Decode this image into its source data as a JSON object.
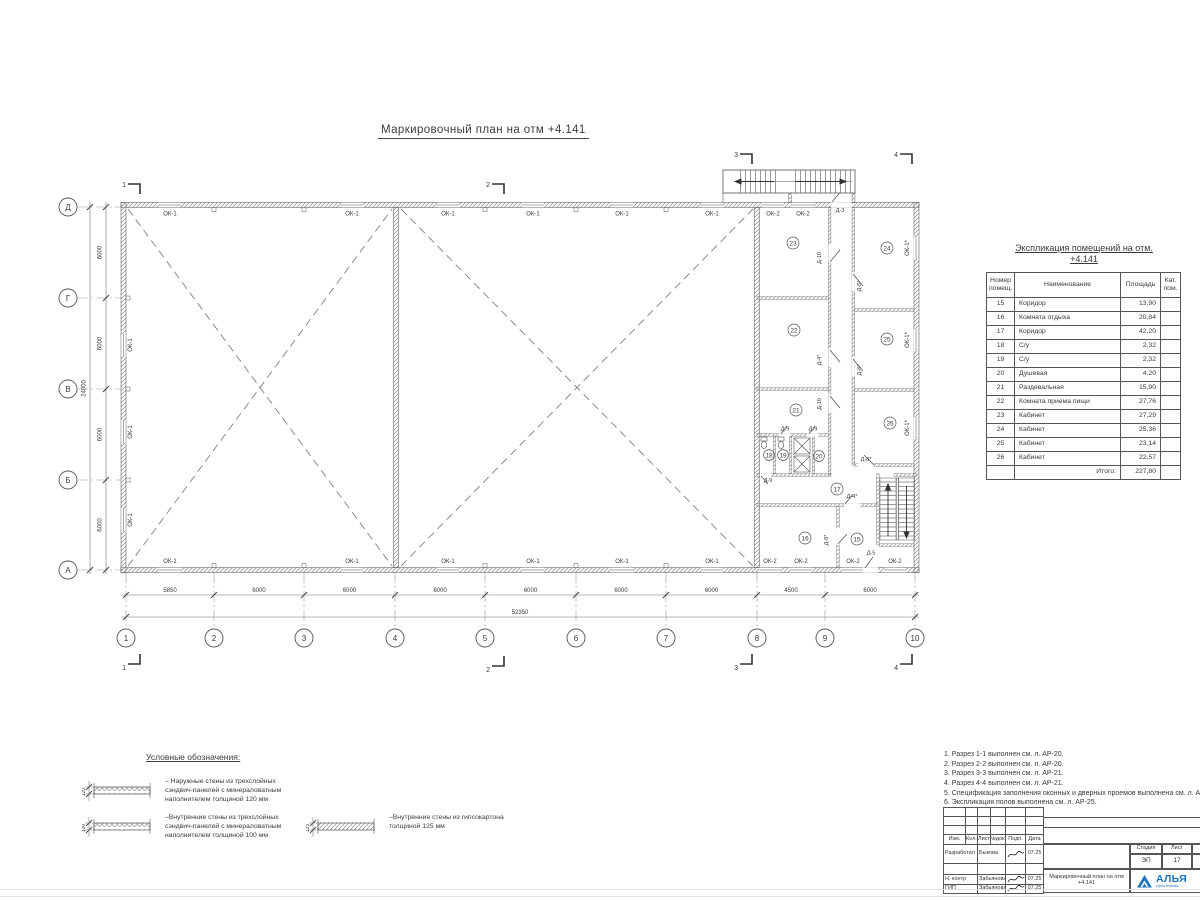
{
  "drawing": {
    "title": "Маркировочный план на отм +4.141"
  },
  "plan": {
    "rows": [
      "Д",
      "Г",
      "В",
      "Б",
      "А"
    ],
    "cols": [
      "1",
      "2",
      "3",
      "4",
      "5",
      "6",
      "7",
      "8",
      "9",
      "10"
    ],
    "dims_bottom": [
      "5850",
      "6000",
      "6000",
      "6000",
      "6000",
      "6000",
      "6000",
      "4500",
      "6000"
    ],
    "dim_bottom_total": "52350",
    "dims_left": [
      "6000",
      "6000",
      "6000",
      "6000"
    ],
    "dim_left_total": "24000",
    "win": {
      "ok1": "ОК-1",
      "ok2": "ОК-2",
      "ok1s": "ОК-1*"
    },
    "door": {
      "d3": "Д-3",
      "d4": "Д-4*",
      "d5": "Д-5",
      "d8": "Д-8*",
      "d9": "Д-9",
      "d10": "Д-10"
    },
    "room": {
      "r15": "15",
      "r16": "16",
      "r17": "17",
      "r18": "18",
      "r19": "19",
      "r20": "20",
      "r21": "21",
      "r22": "22",
      "r23": "23",
      "r24": "24",
      "r25": "25",
      "r26": "26"
    },
    "sec": {
      "s1": "1",
      "s2": "2",
      "s3": "3",
      "s4": "4"
    }
  },
  "explication": {
    "title_line1": "Экспликация помещений на отм.",
    "title_line2": "+4.141",
    "headers": [
      "Номер помещ.",
      "Наименование",
      "Площадь",
      "Кат. пом."
    ],
    "rows": [
      {
        "num": "15",
        "name": "Коридор",
        "area": "13,90"
      },
      {
        "num": "16",
        "name": "Комната отдыха",
        "area": "20,84"
      },
      {
        "num": "17",
        "name": "Коридор",
        "area": "42,20"
      },
      {
        "num": "18",
        "name": "С/у",
        "area": "2,32"
      },
      {
        "num": "19",
        "name": "С/у",
        "area": "2,32"
      },
      {
        "num": "20",
        "name": "Душевая",
        "area": "4,20"
      },
      {
        "num": "21",
        "name": "Раздевальная",
        "area": "15,90"
      },
      {
        "num": "22",
        "name": "Комната приема пищи",
        "area": "27,76"
      },
      {
        "num": "23",
        "name": "Кабинет",
        "area": "27,29"
      },
      {
        "num": "24",
        "name": "Кабинет",
        "area": "25,36"
      },
      {
        "num": "25",
        "name": "Кабинет",
        "area": "23,14"
      },
      {
        "num": "26",
        "name": "Кабинет",
        "area": "22,57"
      }
    ],
    "total_label": "Итого:",
    "total_value": "227,80"
  },
  "legend": {
    "title": "Условные обозначения:",
    "items": [
      {
        "dim": "120",
        "text": "– Наружные стены из трехслойных сэндвич-панелей с минераловатным наполнителем толщиной 120 мм"
      },
      {
        "dim": "100",
        "text": "–Внутренние стены из трехслойных сэндвич-панелей с минераловатным наполнителем толщиной 100 мм"
      },
      {
        "dim": "125",
        "text": "–Внутренние стены из гипсокартона толщиной 125 мм"
      }
    ]
  },
  "notes": {
    "items": [
      "1. Разрез 1-1 выполнен см. л. АР-20.",
      "2. Разрез 2-2 выполнен см. л. АР-20.",
      "3. Разрез 3-3 выполнен см. л. АР-21.",
      "4. Разрез 4-4 выполнен см. л. АР-21.",
      "5. Спецификация заполнения оконных и дверных проемов выполнена см. л. АР-23, АР-24.",
      "6. Экспликация полов выполнена см. л. АР-25."
    ]
  },
  "titleblock": {
    "header_cells": [
      "Изм.",
      "Кол.",
      "Лист",
      "№док.",
      "Подп.",
      "Дата"
    ],
    "rows": [
      {
        "role": "Разработал",
        "name": "Быкова",
        "date": "07.25"
      },
      {
        "role": "Н. контр",
        "name": "Забьянова",
        "date": "07.25"
      },
      {
        "role": "ГИП",
        "name": "Забьянова",
        "date": "07.25"
      }
    ],
    "doc_title": "Маркировочный план на отм +4.141",
    "stage_label": "Стадия",
    "stage_value": "ЭП",
    "sheet_label": "Лист",
    "sheet_value": "17",
    "logo_text": "АЛЬЯ",
    "logo_sub": "строительная"
  },
  "colors": {
    "logo_blue": "#1e73be",
    "line_gray": "#4a4a4a"
  }
}
